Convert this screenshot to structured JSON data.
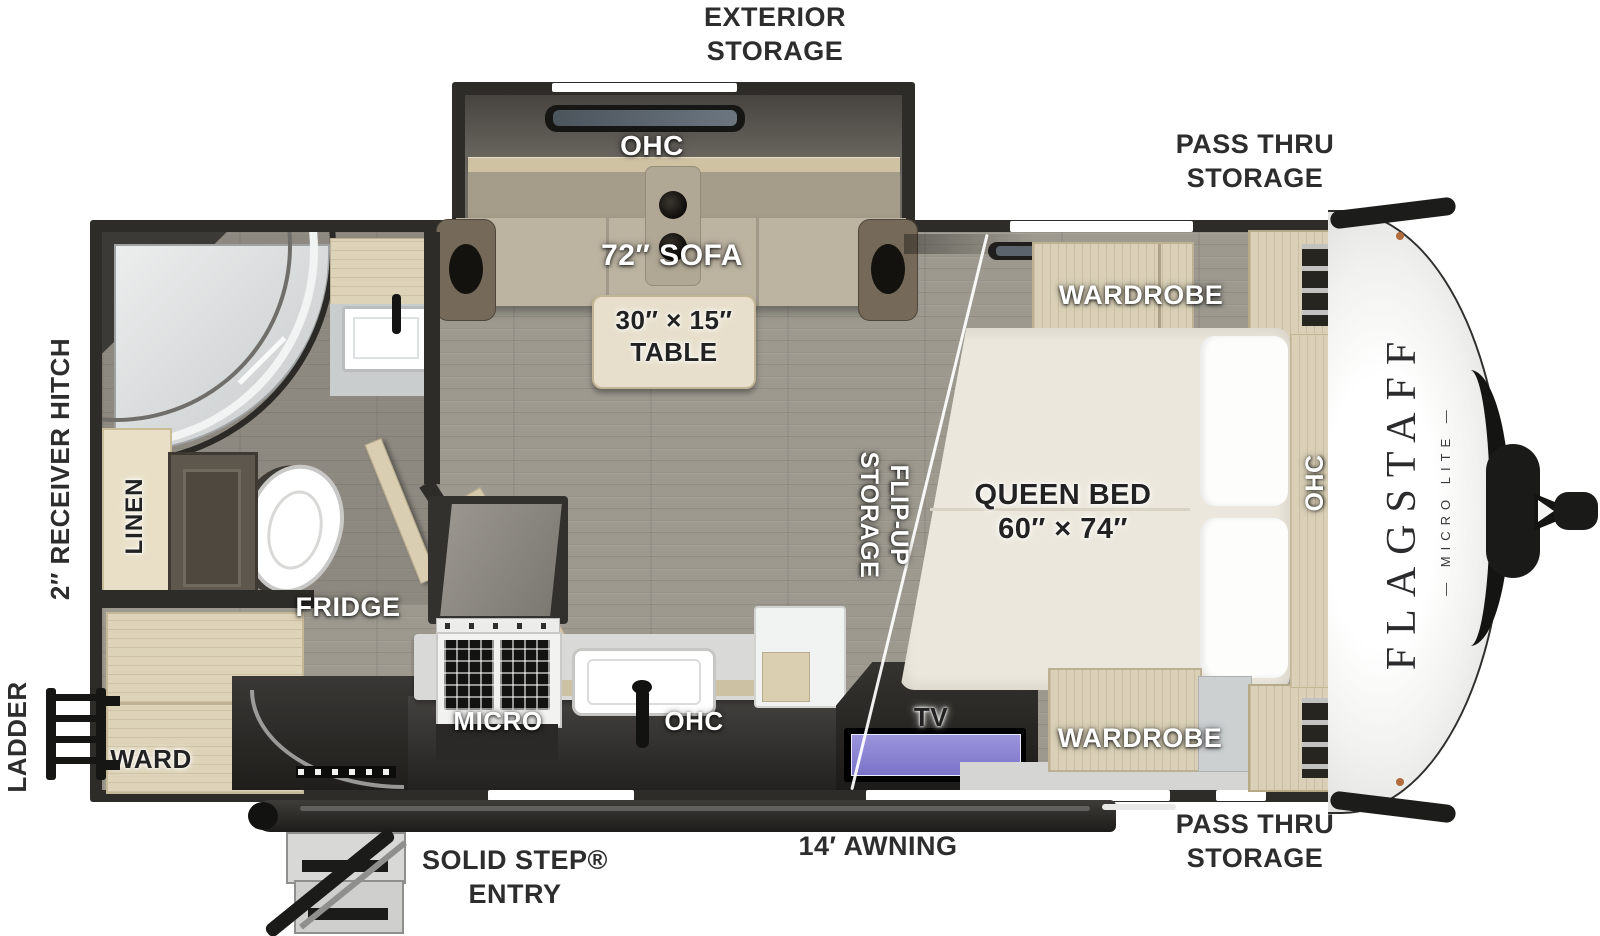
{
  "title": "Flagstaff Micro Lite travel trailer floor plan",
  "colors": {
    "label_dark": "#2d2d2d",
    "wall": "#2e2c29",
    "floor": "#9d998f",
    "sofa_tan": "#bcb3a1",
    "wood_tan": "#ddd3b8",
    "counter_gray": "#d9d9d7",
    "tv_screen_purple": "#8d87d6",
    "mattress_cream": "#ece7dc",
    "cap_white": "#f7f7f5",
    "trim_black": "#1b1b19",
    "marker_orange": "#b26b3a"
  },
  "exterior": {
    "storage_top": {
      "line1": "EXTERIOR",
      "line2": "STORAGE"
    },
    "pass_thru_top": {
      "line1": "PASS THRU",
      "line2": "STORAGE"
    },
    "pass_thru_bottom": {
      "line1": "PASS THRU",
      "line2": "STORAGE"
    },
    "awning": "14′ AWNING",
    "entry": {
      "line1": "SOLID STEP®",
      "line2": "ENTRY"
    },
    "ladder": "LADDER",
    "receiver_hitch": "2″ RECEIVER HITCH",
    "brand": {
      "name": "FLAGSTAFF",
      "sub": "— MICRO LITE —"
    }
  },
  "living": {
    "ohc": "OHC",
    "sofa": "72″ SOFA",
    "table_line1": "30″ × 15″",
    "table_line2": "TABLE",
    "flip_up_line1": "FLIP-UP",
    "flip_up_line2": "STORAGE"
  },
  "kitchen": {
    "fridge": "FRIDGE",
    "micro": "MICRO",
    "ohc": "OHC",
    "tv": "TV"
  },
  "bath": {
    "linen": "LINEN"
  },
  "rear": {
    "ward": "WARD"
  },
  "bedroom": {
    "wardrobe_top": "WARDROBE",
    "wardrobe_bottom": "WARDROBE",
    "bed_line1": "QUEEN BED",
    "bed_line2": "60″ × 74″",
    "ohc": "OHC"
  }
}
